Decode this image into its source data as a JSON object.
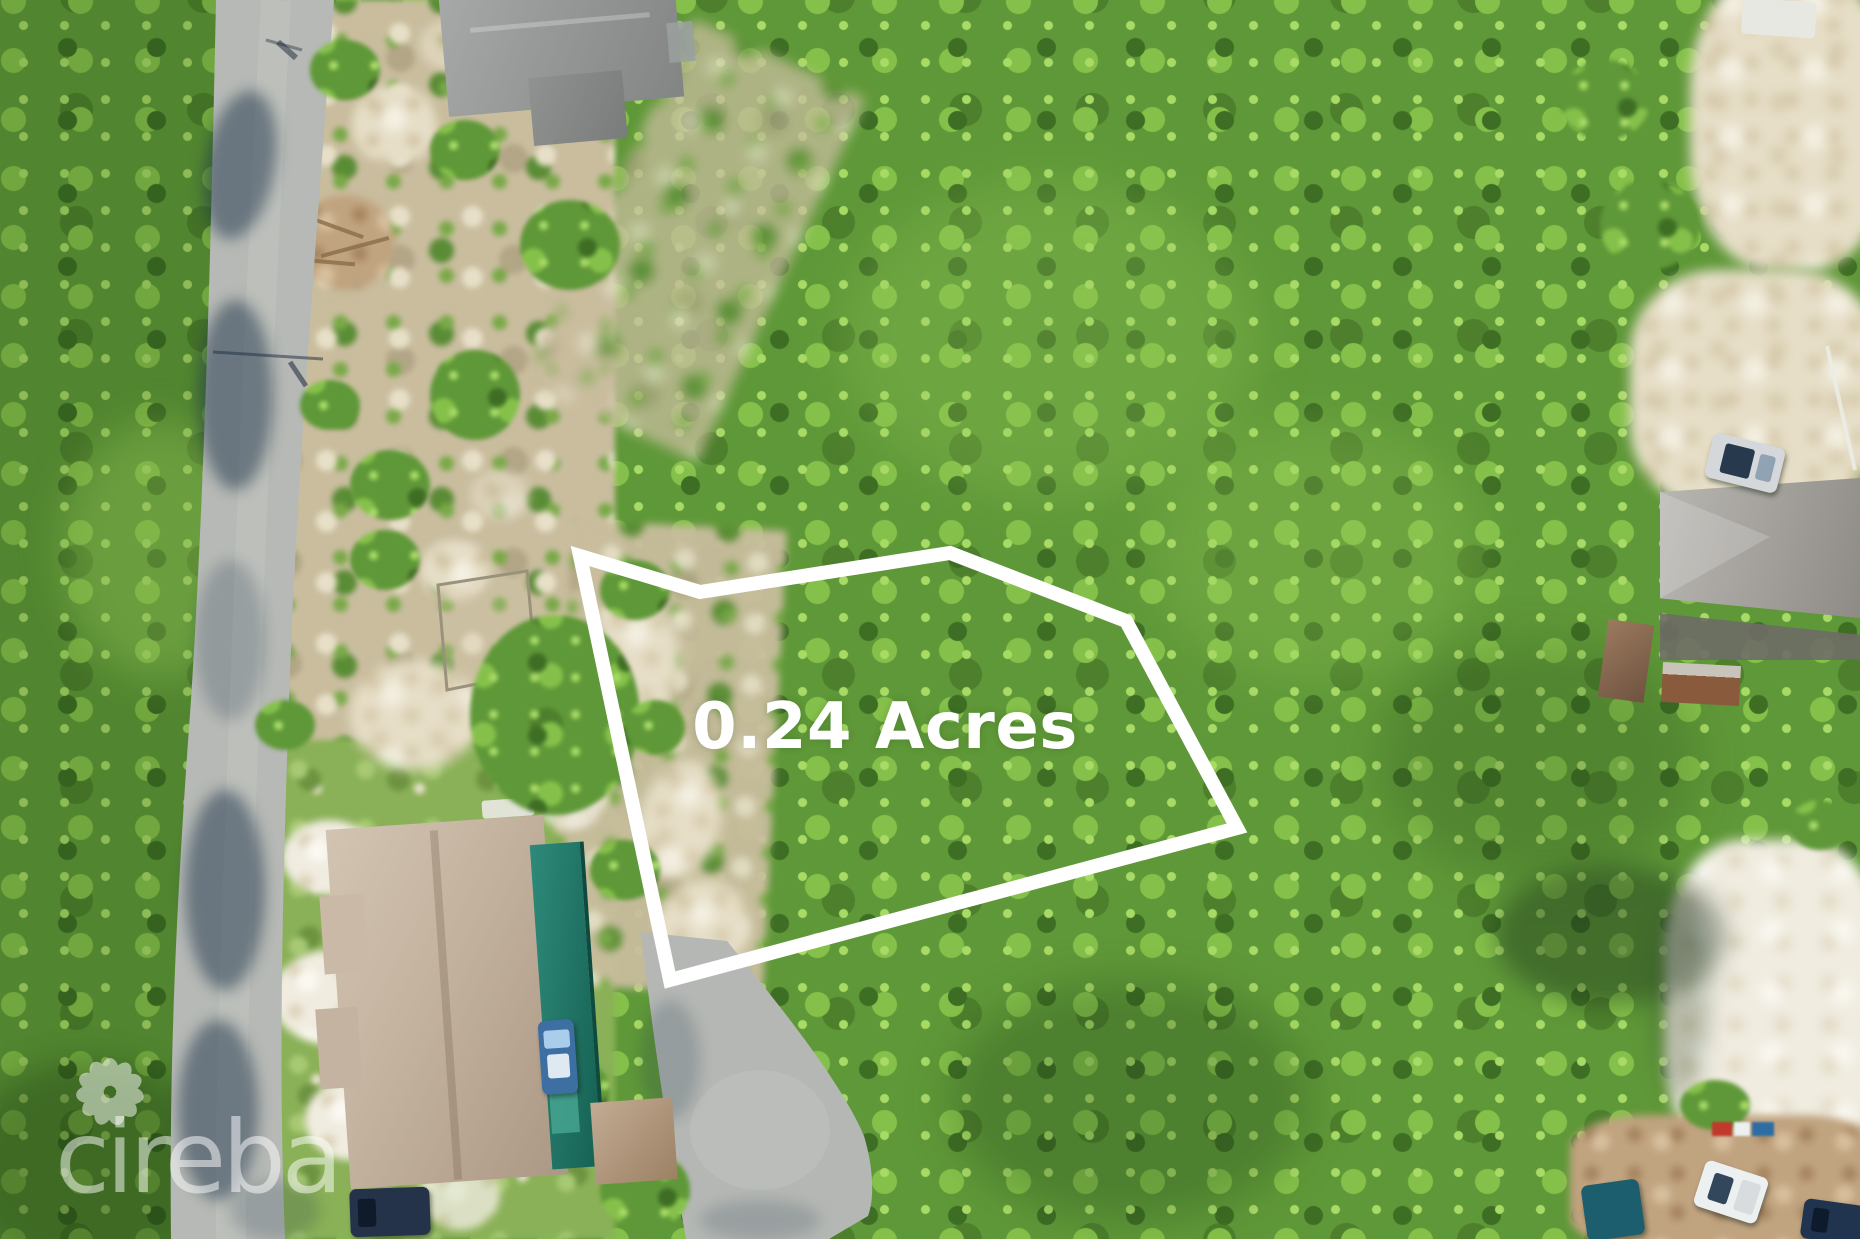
{
  "image_type": "aerial-drone-photo",
  "overlay": {
    "area_label": "0.24 Acres",
    "polygon_points": "580,556 700,592 950,553 1126,621 1237,828 670,980",
    "stroke_color": "#ffffff",
    "stroke_width_px": 14,
    "label_color": "#ffffff"
  },
  "watermark": {
    "text": "cireba",
    "icon": "flower-petal-ring",
    "color": "#ffffff",
    "opacity": 0.5
  },
  "scene": {
    "description": "Aerial view of a vacant 0.24 acre residential lot outlined in white, surrounded by dense green scrub; road along the left edge, cul-de-sac road at bottom center, gray-roofed house top-left, large tan-roofed house with teal lanai bottom-left, gray-roofed house with sheds and parked cars top-right, sandy clearing and trucks bottom-right.",
    "palette": {
      "canopy": "#5f9838",
      "canopy_light": "#a8da66",
      "canopy_dark": "#3e6d24",
      "road": "#b6b9b5",
      "sand": "#e6dec7",
      "white_sand": "#f0ece0",
      "dirt": "#c0a37f",
      "lawn": "#8ab157",
      "roof_gray": "#979a98",
      "roof_tan": "#c6b6a3",
      "teal_structure": "#20796b",
      "road_shadow": "#1e344a"
    }
  }
}
